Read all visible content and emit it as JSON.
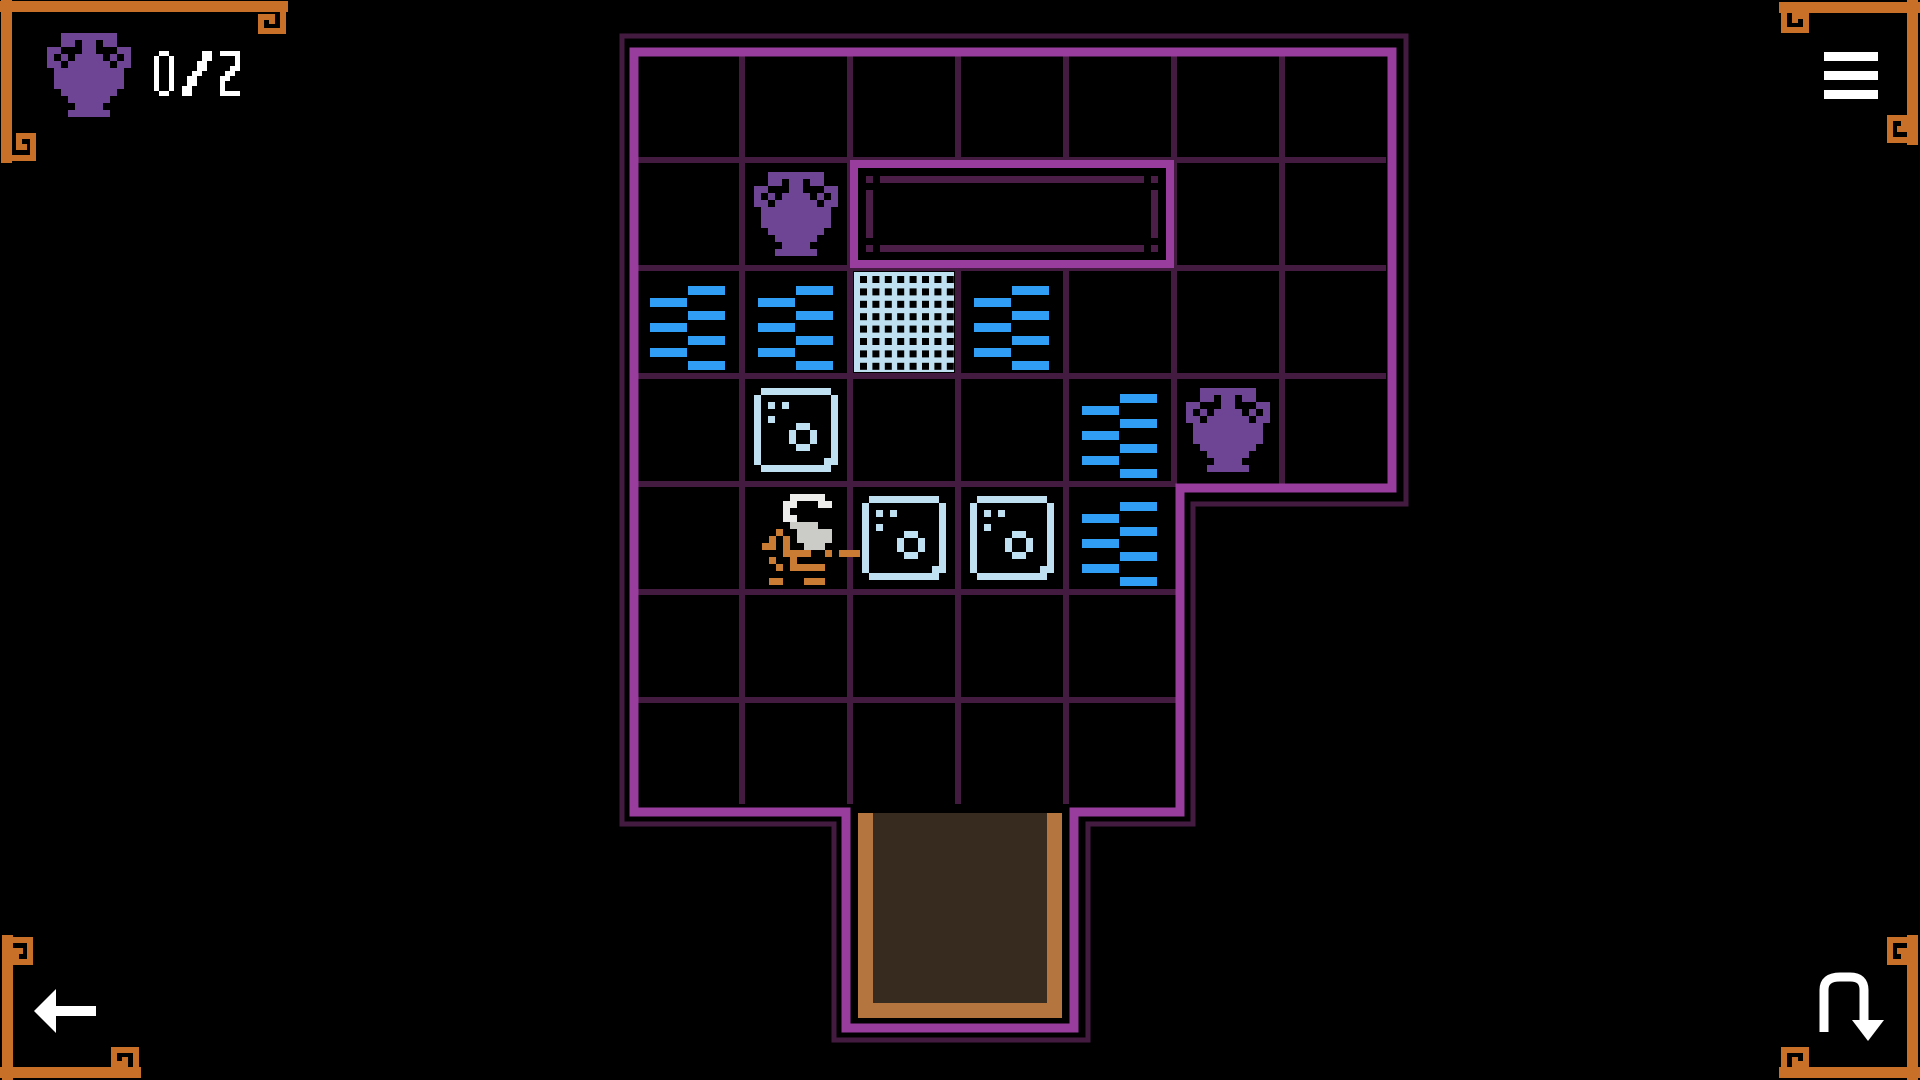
{
  "hud": {
    "counter": {
      "icon": "amphora-icon",
      "value": "0/2"
    },
    "menu_button": {
      "icon": "menu-icon"
    },
    "back_button": {
      "icon": "back-arrow-icon"
    },
    "restart_button": {
      "icon": "restart-arrow-icon"
    }
  },
  "palette": {
    "background": "#000000",
    "wall_bright": "#983c9e",
    "wall_dark": "#431b40",
    "slot_inner": "#4a1e46",
    "amphora_purple": "#6e4594",
    "water_blue": "#2f9ef4",
    "block_pale": "#bee0f1",
    "player_orange": "#ca7c34",
    "player_hair_light": "#ececea",
    "player_hair_shade": "#cbccc8",
    "corner_orange": "#c87028",
    "door_frame_tan": "#b4763e",
    "door_floor_brown": "#372b1f",
    "hud_white": "#ffffff"
  },
  "board": {
    "cols_top_section": 7,
    "rows_top_section": 4,
    "cols_bottom_section": 5,
    "rows_bottom_section": 3,
    "amphorae_collected": 0,
    "amphorae_total": 2,
    "tiles": [
      {
        "type": "amphora",
        "row": 2,
        "col": 2
      },
      {
        "type": "water",
        "row": 3,
        "col": 1
      },
      {
        "type": "water",
        "row": 3,
        "col": 2
      },
      {
        "type": "grate",
        "row": 3,
        "col": 3
      },
      {
        "type": "water",
        "row": 3,
        "col": 4
      },
      {
        "type": "block",
        "row": 4,
        "col": 2
      },
      {
        "type": "water",
        "row": 4,
        "col": 5
      },
      {
        "type": "amphora",
        "row": 4,
        "col": 6
      },
      {
        "type": "player",
        "row": 5,
        "col": 2
      },
      {
        "type": "block",
        "row": 5,
        "col": 3
      },
      {
        "type": "block",
        "row": 5,
        "col": 4
      },
      {
        "type": "water",
        "row": 5,
        "col": 5
      }
    ],
    "slot": {
      "row": 2,
      "col_start": 3,
      "col_end": 5
    },
    "door": {
      "position": "bottom",
      "col_start": 3,
      "col_end": 4
    }
  }
}
